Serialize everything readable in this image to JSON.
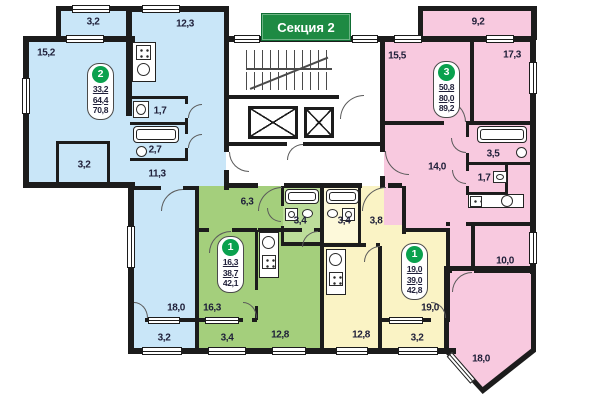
{
  "banner": {
    "text": "Секция 2"
  },
  "colors": {
    "blue": "#c9e6f8",
    "green": "#a4cf7c",
    "green_light": "#bcdd9a",
    "yellow": "#faf3c5",
    "yellow_light": "#fdf9da",
    "pink": "#f8c9df",
    "wall": "#1c1c1c",
    "badge_green": "#0aa14e",
    "banner_green": "#1e8a43"
  },
  "apartments": [
    {
      "key": "blue",
      "number": "2",
      "area_living": "33,2",
      "area_total": "64,4",
      "area_full": "70,8",
      "dims": {
        "balcony_top": "3,2",
        "room_main": "15,2",
        "kitchen": "12,3",
        "wc": "1,7",
        "bath": "2,7",
        "closet": "3,2",
        "hall": "11,3",
        "room_second": "18,0",
        "balcony_bottom": "3,2"
      }
    },
    {
      "key": "green",
      "number": "1",
      "area_living": "16,3",
      "area_total": "38,7",
      "area_full": "42,1",
      "dims": {
        "hall": "6,3",
        "bath": "3,4",
        "room": "16,3",
        "kitchen": "12,8",
        "balcony": "3,4"
      }
    },
    {
      "key": "yellow",
      "number": "1",
      "area_living": "19,0",
      "area_total": "39,0",
      "area_full": "42,8",
      "dims": {
        "bath": "3,4",
        "hall": "3,8",
        "room": "19,0",
        "kitchen": "12,8",
        "balcony": "3,2"
      }
    },
    {
      "key": "pink",
      "number": "3",
      "area_living": "50,8",
      "area_total": "80,0",
      "area_full": "89,2",
      "dims": {
        "balcony_top": "9,2",
        "room_a": "15,5",
        "room_b": "17,3",
        "kitchen_living": "14,0",
        "bath": "3,5",
        "wc": "1,7",
        "room_c": "10,0",
        "room_d": "18,0"
      }
    }
  ]
}
